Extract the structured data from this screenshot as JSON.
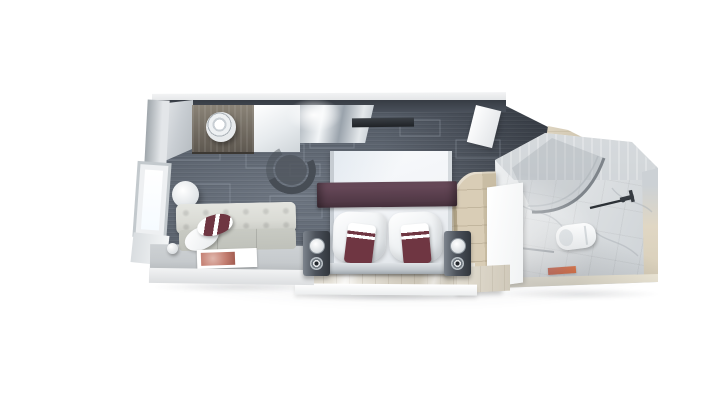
{
  "scene": {
    "description": "Top-down 3D rendering of a cruise ship balcony stateroom floor plan on a white background",
    "background": "#ffffff"
  },
  "palette": {
    "bg": "#ffffff",
    "carpet": "#5d6673",
    "carpet_dark": "#3e444e",
    "carpet_line": "#aab3bf",
    "wall_dark": "#363b43",
    "wall_cap": "#e3e5e7",
    "wood_counter": "#5e5850",
    "wood_counter_hi": "#8a8377",
    "counter_white": "#eef1f3",
    "silver": "#c7cdd3",
    "chair": "#474d55",
    "tv": "#1f2226",
    "door_white": "#f8f9fa",
    "wall_light": "#d6dade",
    "table_top": "#f0f2f4",
    "sofa": "#dadbd5",
    "sofa_seat": "#c8cac3",
    "platform_top": "#c6cacd",
    "platform_front": "#f2f3f4",
    "magazine_img": "#c47f72",
    "bed": "#f3f5f8",
    "bed_edge": "#c6ccd2",
    "runner": "#5e4251",
    "runner_dark": "#4a3440",
    "cushion": "#6f3642",
    "headboard": "#c2c8cd",
    "nightstand": "#4d535c",
    "nightstand_hi": "#7d848d",
    "lamp": "#f5f7f8",
    "chrome": "#9ba3ab",
    "wood_floor": "#d6d0c3",
    "wood_floor_hi": "#efece4",
    "wardrobe": "#d9cdb6",
    "wardrobe_dark": "#b3a689",
    "marble_floor": "#e0e3e5",
    "marble_wall": "#c9ced2",
    "marble_vein": "#aeb4ba",
    "travertine": "#e0d7c4",
    "travertine_dark": "#c6bba3",
    "toilet": "#ffffff",
    "shower_line": "#7e848a",
    "glass_line": "#2c3136",
    "fixture": "#363b41",
    "mat": "#c0503a",
    "mat_hot": "#e2703f"
  },
  "rooms": {
    "living": {
      "label": "Living and sleeping area with dark patterned carpet"
    },
    "entry": {
      "label": "Entry corridor with light wood floor"
    },
    "bathroom": {
      "label": "Marble bathroom with shower, toilet and washbasin"
    }
  },
  "items": {
    "carpet": {
      "label": "Dark grey carpet with light rectangular line pattern"
    },
    "top_wall": {
      "label": "Cabin top wall (cutaway)"
    },
    "corner_cabinet": {
      "label": "Corner cabinet"
    },
    "minibar_counter": {
      "label": "Dark wood minibar counter"
    },
    "ice_bucket": {
      "label": "Round ice bucket on counter"
    },
    "vanity": {
      "label": "White vanity panel"
    },
    "desk": {
      "label": "Mirrored dressing desk"
    },
    "desk_chair": {
      "label": "Curved desk chair"
    },
    "tv": {
      "label": "Wall-mounted TV"
    },
    "cabin_door": {
      "label": "Open cabin entrance door"
    },
    "window": {
      "label": "Window on balcony wall"
    },
    "side_table": {
      "label": "Round side table"
    },
    "sofa": {
      "label": "Tufted sofa with cushions"
    },
    "sofa_pillow_white": {
      "label": "White sofa pillow"
    },
    "sofa_pillow_accent": {
      "label": "Burgundy striped sofa pillow"
    },
    "coffee_table": {
      "label": "Low table in front of sofa"
    },
    "magazine": {
      "label": "Magazine on table"
    },
    "sphere_lamp": {
      "label": "Small round lamp"
    },
    "bed": {
      "label": "Double bed with white duvet"
    },
    "runner": {
      "label": "Plum bed runner"
    },
    "pillow_left": {
      "label": "Left pillow with burgundy cushion"
    },
    "pillow_right": {
      "label": "Right pillow with burgundy cushion"
    },
    "headboard": {
      "label": "Headboard bench"
    },
    "nightstand_left": {
      "label": "Left bedside unit with lamp"
    },
    "nightstand_right": {
      "label": "Right bedside unit with lamp"
    },
    "wood_floor": {
      "label": "Light wood entry flooring"
    },
    "wardrobe": {
      "label": "Curved wood wardrobe"
    },
    "wardrobe_door": {
      "label": "Open white wardrobe / bathroom door"
    },
    "shower": {
      "label": "Curved glass shower enclosure"
    },
    "toilet": {
      "label": "Wall-hung toilet"
    },
    "faucet": {
      "label": "Washbasin faucet"
    },
    "towel_rail": {
      "label": "Towel rail"
    },
    "bath_mat": {
      "label": "Red bath mat"
    }
  }
}
